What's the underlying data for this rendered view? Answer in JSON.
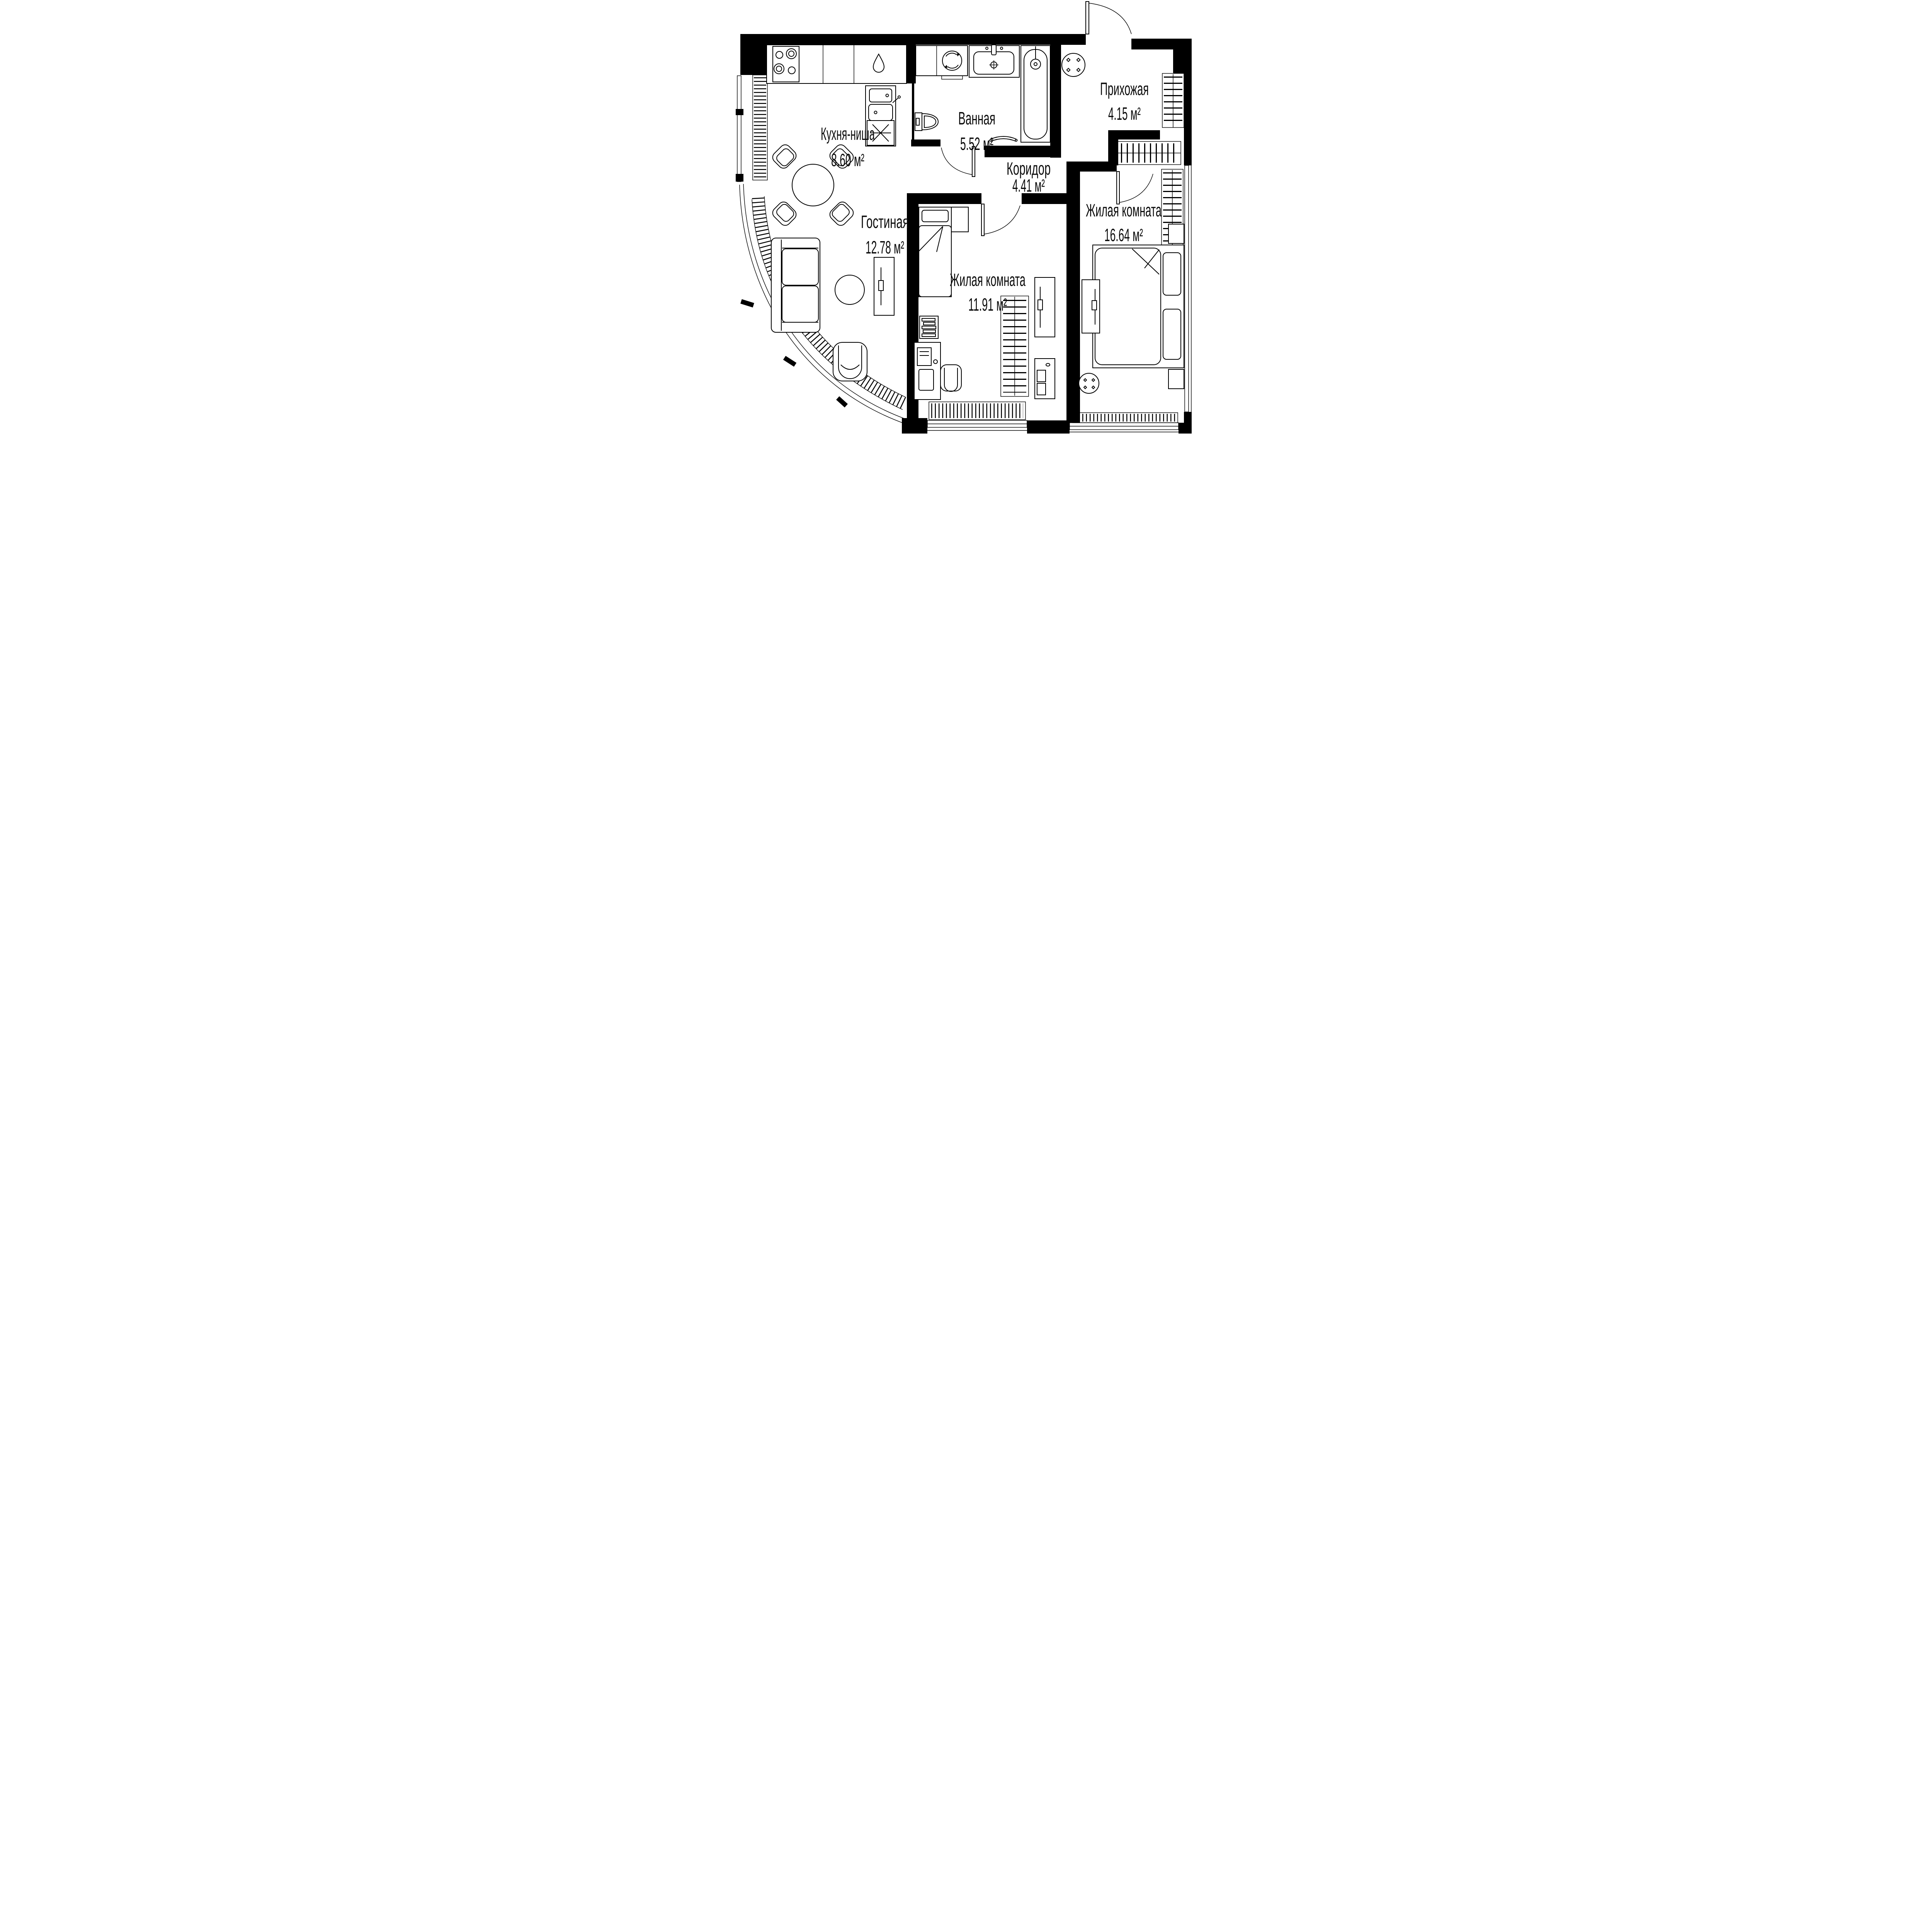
{
  "plan": {
    "type": "apartment-floor-plan",
    "units": "м²",
    "rooms": [
      {
        "id": "kitchen",
        "name": "Кухня-ниша",
        "area": "8.60 м²"
      },
      {
        "id": "bathroom",
        "name": "Ванная",
        "area": "5.52 м²"
      },
      {
        "id": "entry",
        "name": "Прихожая",
        "area": "4.15 м²"
      },
      {
        "id": "corridor",
        "name": "Коридор",
        "area": "4.41 м²"
      },
      {
        "id": "living",
        "name": "Гостиная",
        "area": "12.78 м²"
      },
      {
        "id": "bedroom1",
        "name": "Жилая комната",
        "area": "11.91 м²"
      },
      {
        "id": "bedroom2",
        "name": "Жилая комната",
        "area": "16.64 м²"
      }
    ],
    "fixtures": [
      "stove",
      "kitchen-sink",
      "dishwasher",
      "dining-table",
      "washing-machine",
      "vanity-sink",
      "bathtub",
      "toilet",
      "towel-rail",
      "entry-table",
      "wardrobe",
      "sofa",
      "coffee-table",
      "armchair",
      "tv-stand",
      "single-bed",
      "desk",
      "office-chair",
      "bookshelf",
      "dresser",
      "double-bed",
      "nightstand",
      "round-table",
      "radiator",
      "window",
      "door"
    ],
    "colors": {
      "wall": "#000000",
      "background": "#ffffff",
      "line": "#0b0b0b"
    }
  }
}
